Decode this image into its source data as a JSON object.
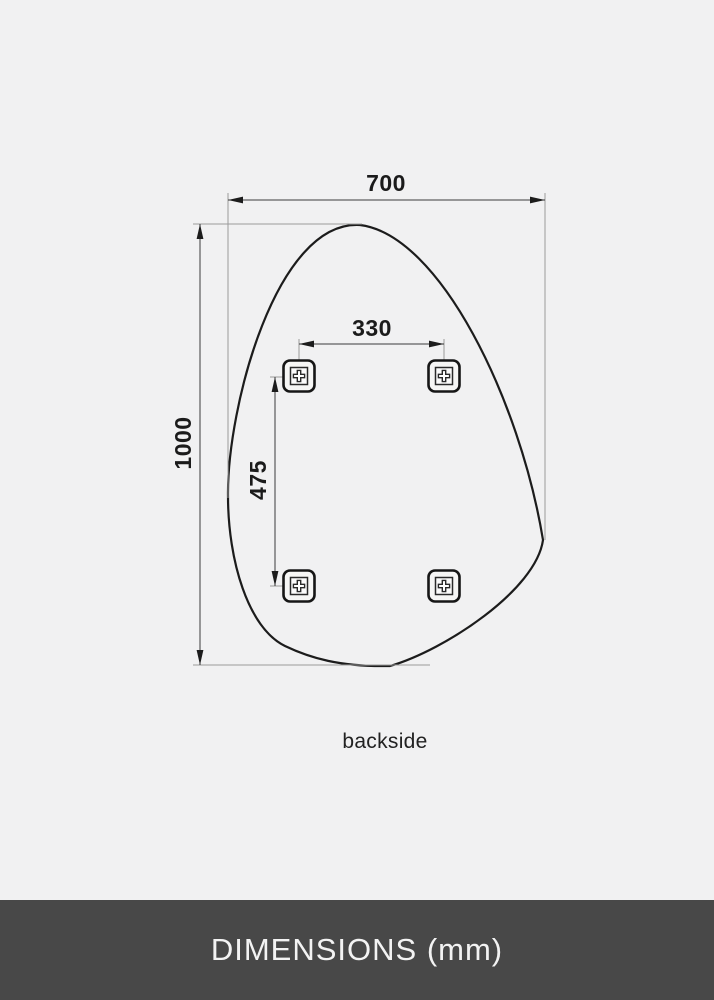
{
  "diagram": {
    "caption": "backside",
    "unit_note": "mm",
    "dimensions": {
      "overall_width": {
        "value": "700",
        "orientation": "horizontal"
      },
      "overall_height": {
        "value": "1000",
        "orientation": "vertical"
      },
      "bracket_spacing_horizontal": {
        "value": "330",
        "orientation": "horizontal"
      },
      "bracket_spacing_vertical": {
        "value": "475",
        "orientation": "vertical"
      }
    },
    "brackets": {
      "count": 4,
      "icon": "screw-mount-bracket-icon"
    },
    "shape": "organic-pebble-mirror-outline"
  },
  "footer": {
    "title": "DIMENSIONS (mm)"
  },
  "colors": {
    "background": "#f1f1f2",
    "outline": "#1c1c1c",
    "dimension_line": "#3c3c3c",
    "extension_line": "#9b9b9b",
    "footer_bg": "#484848",
    "footer_text": "#f3f3f3"
  }
}
